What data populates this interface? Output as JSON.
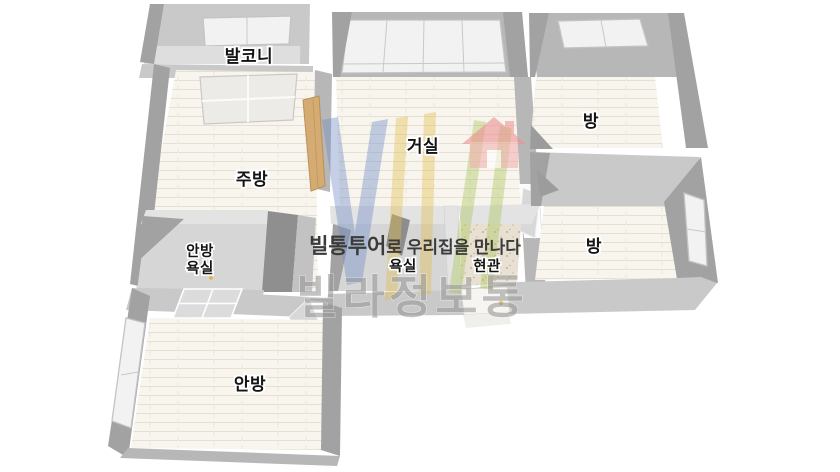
{
  "rooms": {
    "balcony": "발코니",
    "kitchen": "주방",
    "living": "거실",
    "room_top_right": "방",
    "room_mid_right": "방",
    "master_bath_line1": "안방",
    "master_bath_line2": "욕실",
    "bath": "욕실",
    "entrance": "현관",
    "master_bedroom": "안방"
  },
  "watermark": {
    "slogan_brand": "빌통투어",
    "slogan_rest": "로 우리집을 만나다",
    "brand": "빌라정보통"
  },
  "colors": {
    "wall_dark": "#a2a2a2",
    "wall_mid": "#b7b7b7",
    "wall_light": "#c9c9c9",
    "wall_top": "#e3e3e3",
    "floor": "#f8f5ee",
    "floor_gray": "#dedede",
    "bath_floor": "#d6d6d6",
    "entrance_floor": "#e8e1d3",
    "brand_gray": "#9a9a9a",
    "handle_yellow": "#e5b52e",
    "logo_blue": "#6f8cc7",
    "logo_yellow": "#e3bf4e",
    "logo_green": "#aac459",
    "logo_house": "#ee9999",
    "wood": "#d4ab72"
  }
}
